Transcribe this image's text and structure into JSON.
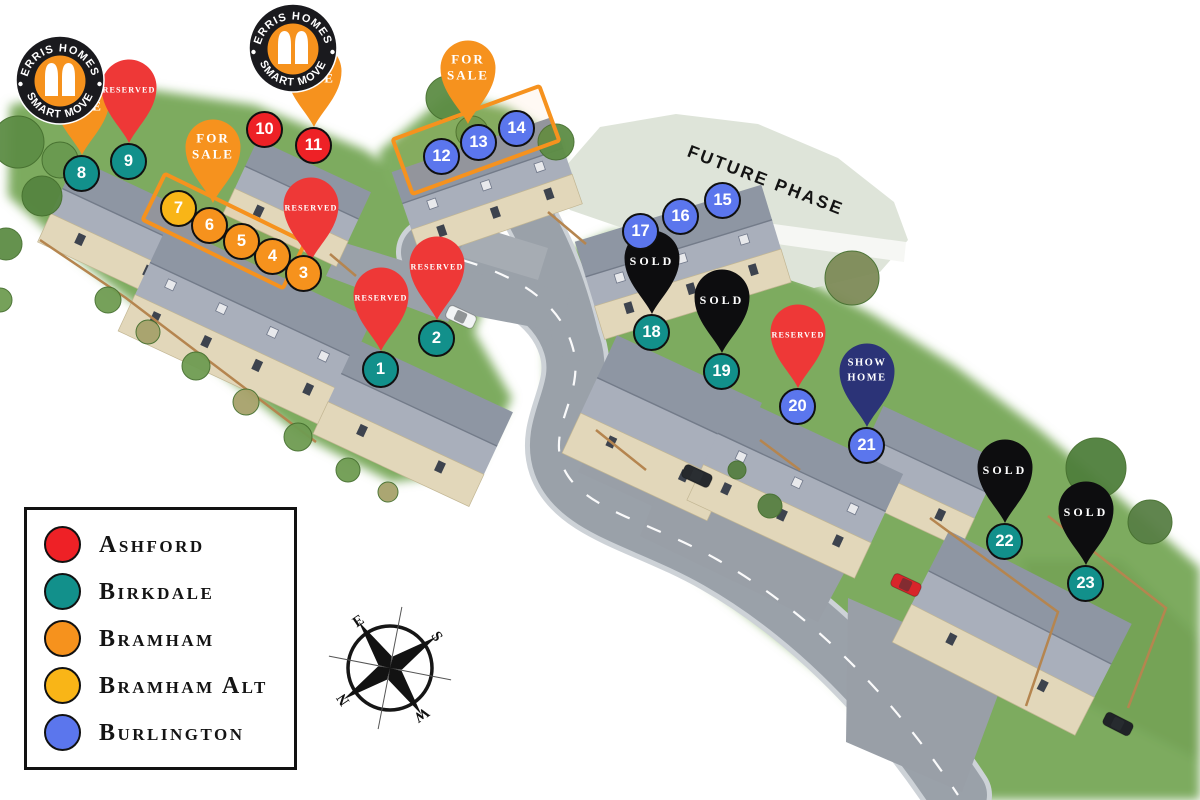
{
  "branding": {
    "ring_top": "ERRIS HOMES",
    "ring_bottom": "SMART MOVE"
  },
  "future_phase_label": "FUTURE PHASE",
  "compass_letters": [
    "N",
    "E",
    "S",
    "W"
  ],
  "statuses": {
    "for_sale": {
      "label": "FOR SALE",
      "lines": [
        "FOR",
        "SALE"
      ],
      "color": "#F6921E"
    },
    "reserved": {
      "label": "RESERVED",
      "lines": [
        "RESERVED"
      ],
      "color": "#EE3837"
    },
    "sold": {
      "label": "SOLD",
      "lines": [
        "SOLD"
      ],
      "color": "#0D0D0F"
    },
    "show_home": {
      "label": "SHOW HOME",
      "lines": [
        "SHOW",
        "HOME"
      ],
      "color": "#2B3377"
    }
  },
  "house_types": [
    {
      "name": "Ashford",
      "color": "#EE2126"
    },
    {
      "name": "Birkdale",
      "color": "#12908B"
    },
    {
      "name": "Bramham",
      "color": "#F6921D"
    },
    {
      "name": "Bramham Alt",
      "color": "#F9B517"
    },
    {
      "name": "Burlington",
      "color": "#5B76ED"
    }
  ],
  "plots": [
    {
      "number": "1",
      "type": "Birkdale",
      "x": 381,
      "y": 370,
      "pin": "reserved"
    },
    {
      "number": "2",
      "type": "Birkdale",
      "x": 437,
      "y": 339,
      "pin": "reserved"
    },
    {
      "number": "3",
      "type": "Bramham",
      "x": 304,
      "y": 274,
      "pin": "reserved",
      "pin_tip": [
        311,
        261
      ]
    },
    {
      "number": "4",
      "type": "Bramham",
      "x": 273,
      "y": 257
    },
    {
      "number": "5",
      "type": "Bramham",
      "x": 242,
      "y": 242
    },
    {
      "number": "6",
      "type": "Bramham",
      "x": 210,
      "y": 226
    },
    {
      "number": "7",
      "type": "Bramham Alt",
      "x": 179,
      "y": 209
    },
    {
      "number": "8",
      "type": "Birkdale",
      "x": 82,
      "y": 174,
      "pin": "for_sale"
    },
    {
      "number": "9",
      "type": "Birkdale",
      "x": 129,
      "y": 162,
      "pin": "reserved"
    },
    {
      "number": "10",
      "type": "Ashford",
      "x": 265,
      "y": 130
    },
    {
      "number": "11",
      "type": "Ashford",
      "x": 314,
      "y": 146,
      "pin": "for_sale"
    },
    {
      "number": "12",
      "type": "Burlington",
      "x": 442,
      "y": 157
    },
    {
      "number": "13",
      "type": "Burlington",
      "x": 479,
      "y": 143
    },
    {
      "number": "14",
      "type": "Burlington",
      "x": 517,
      "y": 129
    },
    {
      "number": "15",
      "type": "Burlington",
      "x": 723,
      "y": 201
    },
    {
      "number": "16",
      "type": "Burlington",
      "x": 681,
      "y": 217
    },
    {
      "number": "17",
      "type": "Burlington",
      "x": 641,
      "y": 232
    },
    {
      "number": "18",
      "type": "Birkdale",
      "x": 652,
      "y": 333,
      "pin": "sold"
    },
    {
      "number": "19",
      "type": "Birkdale",
      "x": 722,
      "y": 372,
      "pin": "sold"
    },
    {
      "number": "20",
      "type": "Burlington",
      "x": 798,
      "y": 407,
      "pin": "reserved"
    },
    {
      "number": "21",
      "type": "Burlington",
      "x": 867,
      "y": 446,
      "pin": "show_home"
    },
    {
      "number": "22",
      "type": "Birkdale",
      "x": 1005,
      "y": 542,
      "pin": "sold"
    },
    {
      "number": "23",
      "type": "Birkdale",
      "x": 1086,
      "y": 584,
      "pin": "sold"
    }
  ],
  "groups": [
    {
      "plots": "4-7",
      "pin": "for_sale",
      "pin_tip": [
        213,
        203
      ],
      "rect": {
        "cx": 224,
        "cy": 231,
        "w": 152,
        "h": 47,
        "rot": 26
      }
    },
    {
      "plots": "12-14",
      "pin": "for_sale",
      "pin_tip": [
        468,
        124
      ],
      "rect": {
        "cx": 476,
        "cy": 140,
        "w": 152,
        "h": 54,
        "rot": -20
      }
    }
  ]
}
